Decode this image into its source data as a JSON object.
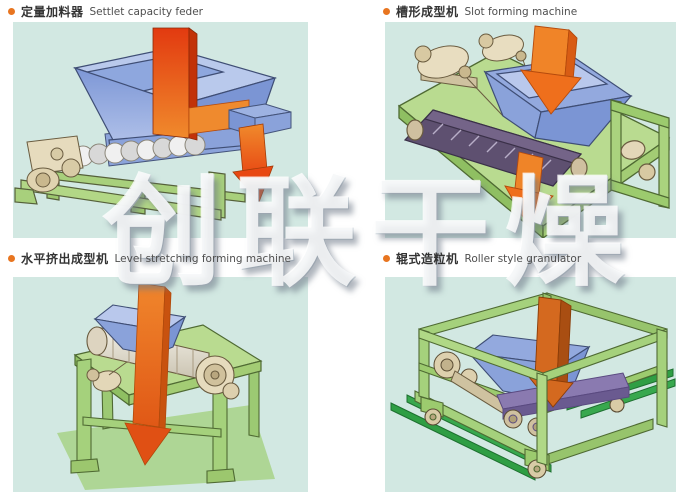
{
  "page": {
    "watermark": "创联干燥"
  },
  "palette": {
    "page_bg": "#ffffff",
    "panel_bg": "#d2e8e2",
    "bullet_orange": "#e87520",
    "label_cn_color": "#333333",
    "label_en_color": "#4e4e4e",
    "hopper_blue": "#8aa2da",
    "arrow_red": "#e23a10",
    "arrow_orange": "#f08a2c",
    "frame_green": "#a5d17c",
    "rail_green": "#2f9e44",
    "machine_tan": "#e6dbbd",
    "belt_purple": "#5e5070",
    "watermark_white": "#ffffff"
  },
  "sections": [
    {
      "id": "settlet-capacity-feeder",
      "label_cn": "定量加料器",
      "label_en": "Settlet capacity feder"
    },
    {
      "id": "slot-forming-machine",
      "label_cn": "槽形成型机",
      "label_en": "Slot forming machine"
    },
    {
      "id": "level-stretching-forming-machine",
      "label_cn": "水平挤出成型机",
      "label_en": "Level stretching forming machine"
    },
    {
      "id": "roller-style-granulator",
      "label_cn": "辊式造粒机",
      "label_en": "Roller style granulator"
    }
  ]
}
